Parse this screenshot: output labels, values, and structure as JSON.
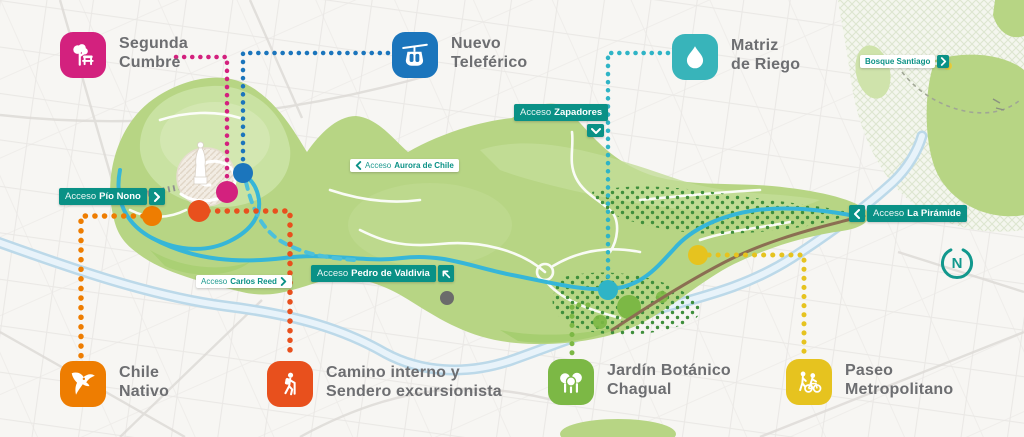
{
  "colors": {
    "park_green": "#b7d584",
    "badge_green": "#0a9186",
    "label_gray": "#6d6e71",
    "river_blue": "#c7dfee",
    "road_cyan": "#36b6d8",
    "compass_teal": "#12988d"
  },
  "legend": {
    "items": [
      {
        "id": "segunda-cumbre",
        "line1": "Segunda",
        "line2": "Cumbre",
        "color": "#d3217e",
        "icon": "tree-bench-icon"
      },
      {
        "id": "nuevo-teleferico",
        "line1": "Nuevo",
        "line2": "Teleférico",
        "color": "#1b75bc",
        "icon": "cable-car-icon"
      },
      {
        "id": "matriz-de-riego",
        "line1": "Matriz",
        "line2": "de Riego",
        "color": "#38b4ba",
        "icon": "water-drop-icon"
      },
      {
        "id": "chile-nativo",
        "line1": "Chile",
        "line2": "Nativo",
        "color": "#ee7d01",
        "icon": "condor-icon"
      },
      {
        "id": "camino-interno",
        "line1": "Camino interno y",
        "line2": "Sendero excursionista",
        "color": "#e8501d",
        "icon": "hiker-icon"
      },
      {
        "id": "jardin-botanico",
        "line1": "Jardín Botánico",
        "line2": "Chagual",
        "color": "#7cb845",
        "icon": "trees-icon"
      },
      {
        "id": "paseo-metropolitano",
        "line1": "Paseo",
        "line2": "Metropolitano",
        "color": "#e6c31f",
        "icon": "pedestrian-cyclist-icon"
      }
    ]
  },
  "badges": [
    {
      "id": "pio-nono",
      "prefix": "Acceso",
      "name": "Pío Nono"
    },
    {
      "id": "zapadores",
      "prefix": "Acceso",
      "name": "Zapadores"
    },
    {
      "id": "aurora-de-chile",
      "prefix": "Acceso",
      "name": "Aurora de Chile"
    },
    {
      "id": "carlos-reed",
      "prefix": "Acceso",
      "name": "Carlos Reed"
    },
    {
      "id": "pedro-de-valdivia",
      "prefix": "Acceso",
      "name": "Pedro de Valdivia"
    },
    {
      "id": "la-piramide",
      "prefix": "Acceso",
      "name": "La Pirámide"
    },
    {
      "id": "bosque-santiago",
      "prefix": "",
      "name": "Bosque Santiago"
    }
  ],
  "compass": {
    "label": "N"
  }
}
